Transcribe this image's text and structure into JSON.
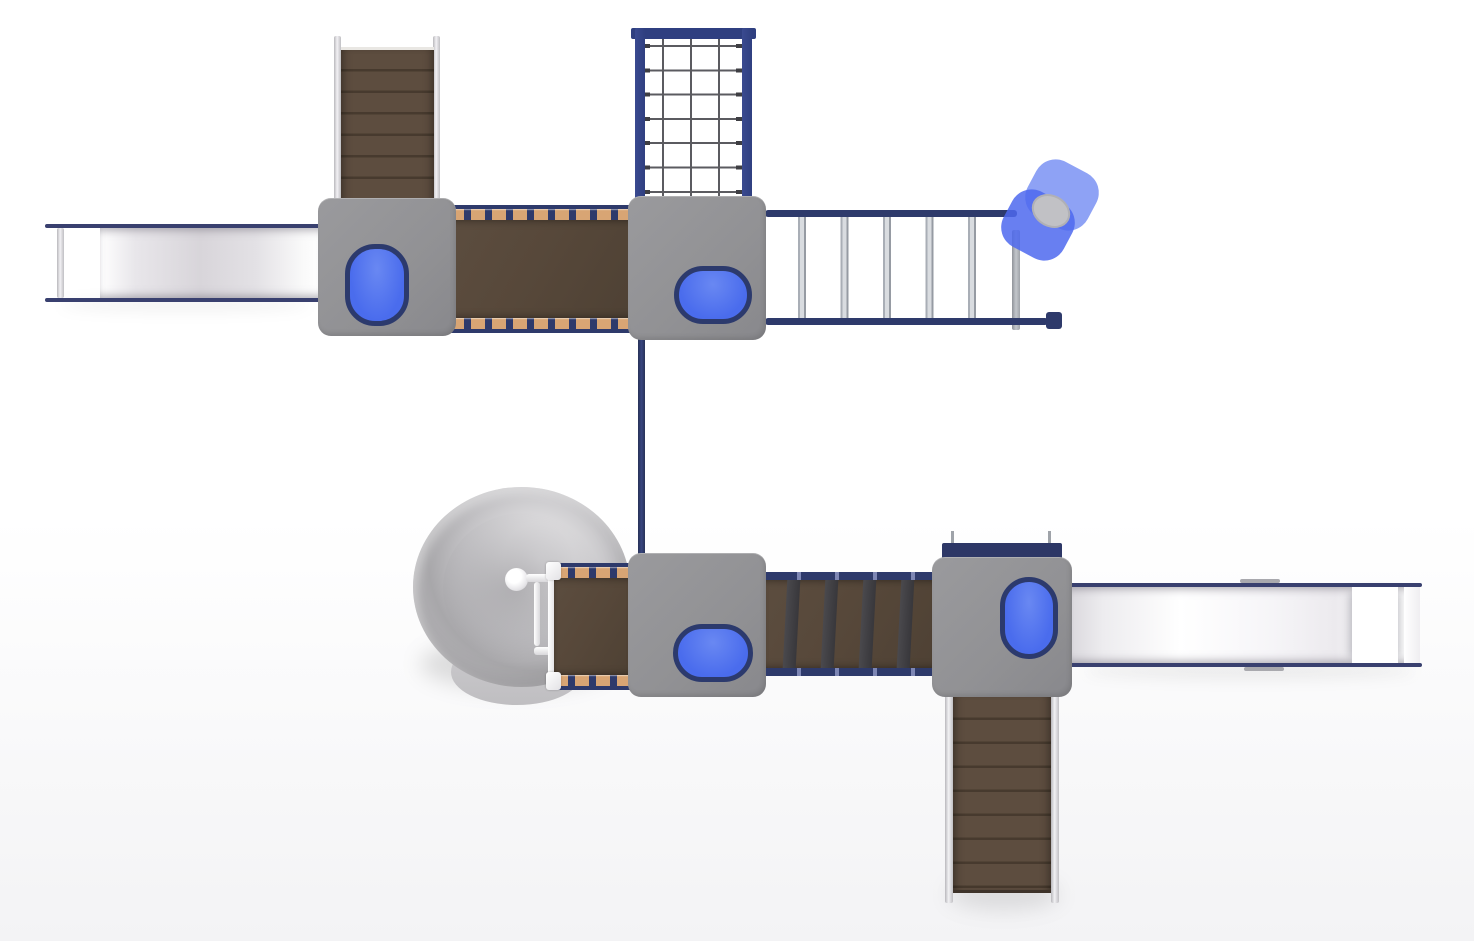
{
  "scene": {
    "title": "Playground play structure — top-down 3D render",
    "view": "plan view",
    "visible_text": "none"
  },
  "colors": {
    "bg-top": "#ffffff",
    "bg-bottom": "#f3f3f5",
    "platform-gray": "#919194",
    "platform-gray-light": "#9a9a9d",
    "hatch-blue": "#4a6ced",
    "hatch-blue-light": "#6988f2",
    "hatch-border": "#2c3a6d",
    "navy": "#2e3a6b",
    "navy-slide": "#39406f",
    "net-frame": "#2f3f80",
    "panel-navy": "#2d3766",
    "rope-gray": "#5b5b60",
    "rope-dot": "#3e3e43",
    "brown": "#57483a",
    "brown-dark": "#4a3c30",
    "brown-line": "#473a2e",
    "tan": "#d8a574",
    "slat-dark": "#414045",
    "rail-light": "#f2f1f4",
    "rail-mid": "#b9b8bc",
    "rung-gray": "#a9aeb6",
    "rung-hi": "#d9dce0",
    "bed-mid": "#d8d5da",
    "dish-light": "#dcdbdd",
    "dish-dark": "#a8a7aa",
    "dish-lip": "#bfbec1",
    "flower-center": "#c1c1c5",
    "post-gray": "#9fa3a9",
    "tab-gray": "#a9a9ae"
  },
  "components": {
    "slide_left": "straight slide exiting west",
    "stairs_top": "stair ramp ascending north",
    "platform_nw": "square deck with blue crawl hatch (vertical)",
    "bridge_top": "wood plank bridge with tan cleats",
    "platform_n": "square deck with blue crawl hatch (horizontal)",
    "cargo_net": "vertical rope climbing net in navy frame",
    "overhead_ladder": "horizontal monkey-bar ladder",
    "flower_spinner": "blue flower spinner climber with gray hub",
    "transfer_pole": "vertical navy connector pole",
    "dish_climber": "gray dish / funnel climber with center post and handles",
    "ramp_bottom": "plank ramp from dish to deck",
    "platform_s": "square deck with blue crawl hatch (horizontal)",
    "bridge_bottom": "clatter bridge with dark slats",
    "platform_se": "square deck with blue crawl hatch (vertical) and navy back panel",
    "slide_right": "straight slide exiting east with exit hump",
    "stairs_bottom": "stair ramp descending south"
  }
}
